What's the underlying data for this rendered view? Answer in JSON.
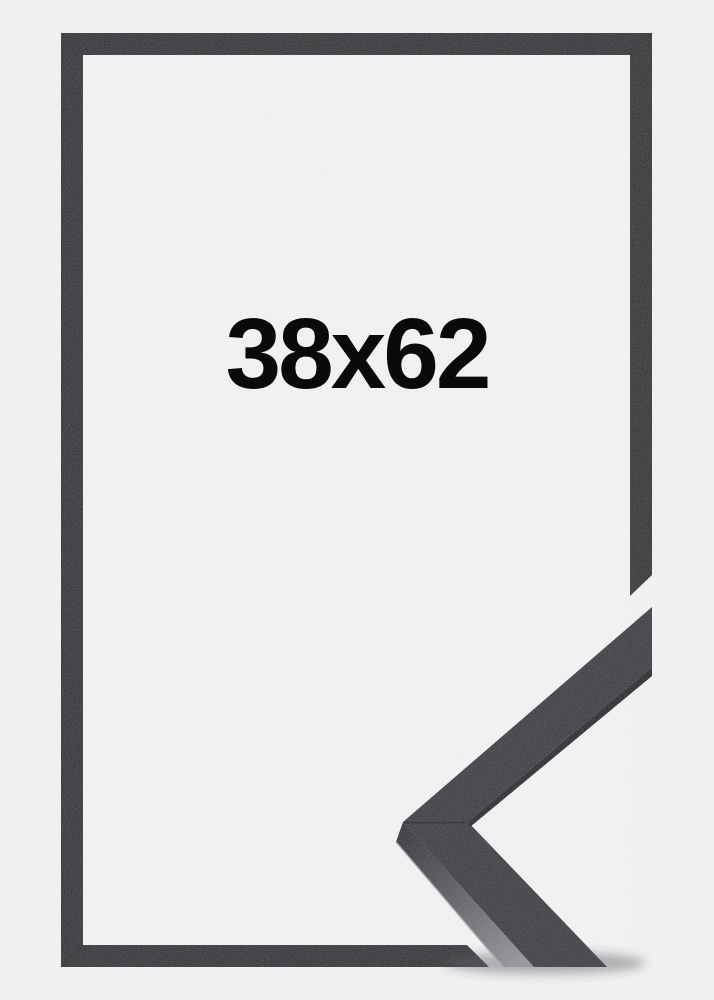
{
  "frame_preview": {
    "size_label": "38x62"
  },
  "colors": {
    "background": "#f0f0f1",
    "opening": "#f4f4f5",
    "frame_black": "#2d2e30",
    "corner_top_face": "#38393d",
    "corner_inner_edge": "#1e1f22",
    "corner_side_dark": "#2b2c2f",
    "corner_side_mid": "#5a5c60",
    "corner_side_light": "#95979b",
    "corner_highlight": "#aeb1b4",
    "label_text": "#0a0a0a"
  }
}
